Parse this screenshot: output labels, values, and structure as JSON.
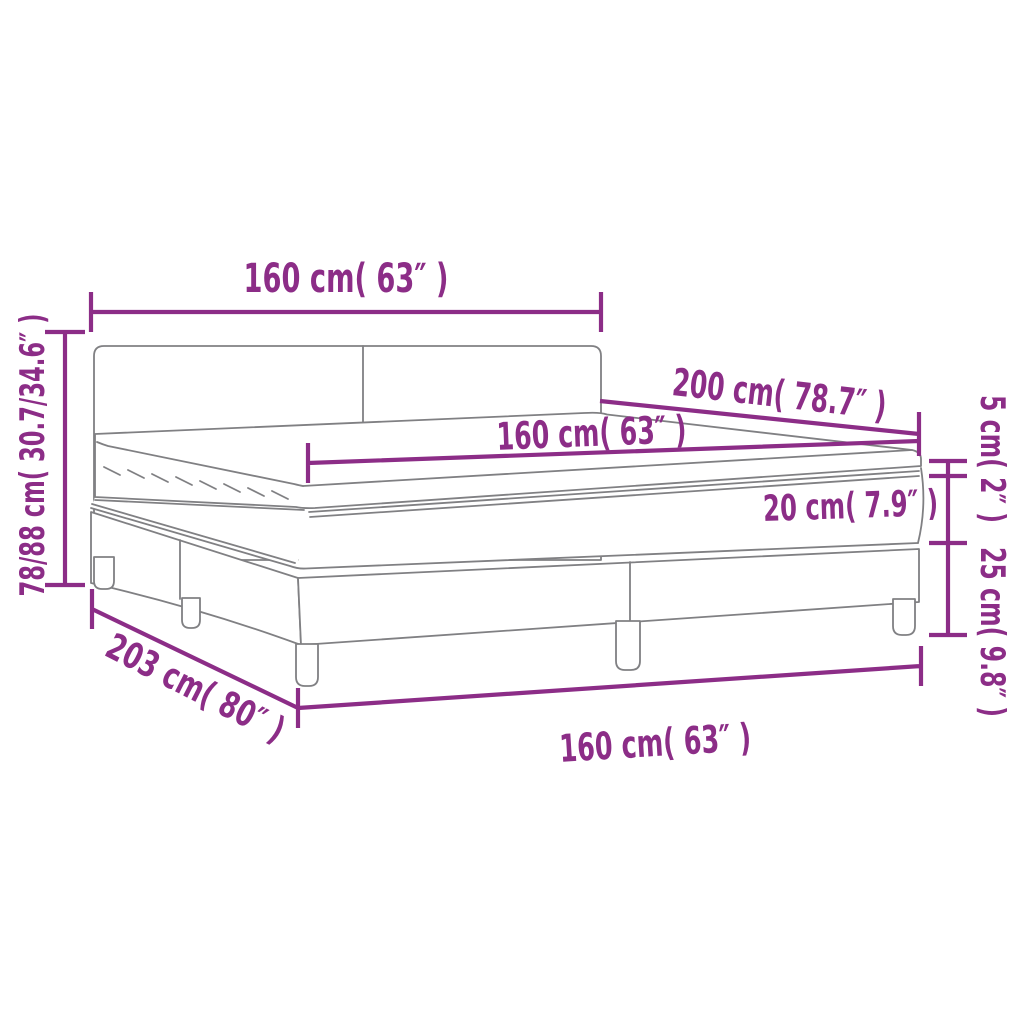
{
  "theme": {
    "accent": "#8C2D87",
    "line": "#808083",
    "bg": "#FFFFFF"
  },
  "diagram": {
    "dimensions": {
      "headboard_width": "160 cm( 63″ )",
      "total_height": "78/88 cm( 30.7/34.6″ )",
      "mattress_length": "200 cm( 78.7″ )",
      "mattress_width": "160 cm( 63″ )",
      "mattress_height": "20 cm( 7.9″ )",
      "topper_height": "5 cm( 2″ )",
      "base_height": "25 cm( 9.8″ )",
      "bed_length": "203 cm( 80″ )",
      "bed_width": "160 cm( 63″ )"
    }
  }
}
